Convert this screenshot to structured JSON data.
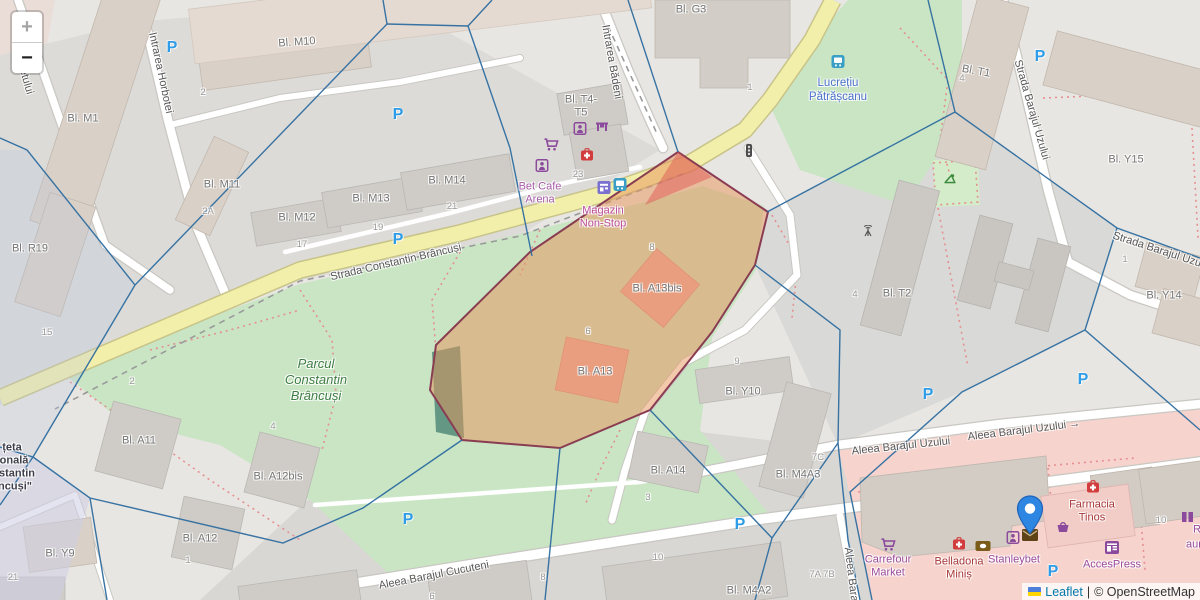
{
  "controls": {
    "zoom_in": "+",
    "zoom_out": "−"
  },
  "attribution": {
    "flag": "ukraine-flag",
    "leaflet": "Leaflet",
    "separator": "|",
    "osm": "© OpenStreetMap"
  },
  "colors": {
    "road_yellow": "#f2efab",
    "park_green": "#c9e5c4",
    "retail_pink": "#f6d3cd",
    "overlay_orange_fill": "#e8935a",
    "overlay_stroke": "#8a3d52",
    "mesh_blue": "#2e6da0",
    "marker_blue": "#2e86e3",
    "parking_blue": "#2e9ce6",
    "shop_purple": "#9b4a9b",
    "pharmacy_red": "#a83838",
    "transit_blue": "#4a70ca",
    "park_label_green": "#3e7d43",
    "leaflet_link": "#0078a8",
    "building_beige": "#d9d0c7",
    "building_grey": "#cfccc7",
    "highlight_building_pink": "#eba9a4"
  },
  "map": {
    "labels": [
      {
        "n": "street-intrarea-horbotei",
        "t": "Intrarea Horbotei",
        "x": 160,
        "y": 73,
        "r": 78,
        "c": "street"
      },
      {
        "n": "street-partial-chetului",
        "t": "chetului",
        "x": 24,
        "y": 76,
        "r": 74,
        "c": "street"
      },
      {
        "n": "street-intrarea-badeni",
        "t": "Intrarea Bădeni",
        "x": 611,
        "y": 62,
        "r": 80,
        "c": "street"
      },
      {
        "n": "street-barajul-uzului-vertical",
        "t": "Strada Barajul Uzului",
        "x": 1031,
        "y": 110,
        "r": 74,
        "c": "street"
      },
      {
        "n": "street-constantin-brancusi",
        "t": "Strada Constantin Brâncuși",
        "x": 396,
        "y": 263,
        "r": -13,
        "c": "street"
      },
      {
        "n": "street-barajul-uzului-diagonal",
        "t": "Strada Barajul Uzului",
        "x": 1162,
        "y": 252,
        "r": 18,
        "c": "street"
      },
      {
        "n": "street-aleea-barajul-cucuteni",
        "t": "Aleea Barajul Cucuteni",
        "x": 434,
        "y": 576,
        "r": -11,
        "c": "street"
      },
      {
        "n": "street-aleea-barajul-uzului-1",
        "t": "Aleea Barajul Uzului",
        "x": 901,
        "y": 447,
        "r": -6,
        "c": "street"
      },
      {
        "n": "street-aleea-barajul-uzului-2",
        "t": "Aleea Barajul Uzului →",
        "x": 1024,
        "y": 431,
        "r": -7,
        "c": "street"
      },
      {
        "n": "street-aleea-barajul-vertical",
        "t": "Aleea Barajul",
        "x": 851,
        "y": 580,
        "r": 83,
        "c": "street"
      },
      {
        "n": "bldg-m10",
        "t": "Bl. M10",
        "x": 297,
        "y": 43,
        "r": -4,
        "c": "bldg"
      },
      {
        "n": "bldg-m1",
        "t": "Bl. M1",
        "x": 83,
        "y": 119,
        "r": 0,
        "c": "bldg"
      },
      {
        "n": "bldg-m11",
        "t": "Bl. M11",
        "x": 222,
        "y": 185,
        "r": 0,
        "c": "bldg"
      },
      {
        "n": "bldg-m12",
        "t": "Bl. M12",
        "x": 297,
        "y": 218,
        "r": 0,
        "c": "bldg"
      },
      {
        "n": "bldg-m13",
        "t": "Bl. M13",
        "x": 371,
        "y": 199,
        "r": 0,
        "c": "bldg"
      },
      {
        "n": "bldg-m14",
        "t": "Bl. M14",
        "x": 447,
        "y": 181,
        "r": 0,
        "c": "bldg"
      },
      {
        "n": "bldg-t4-t5",
        "t": [
          "Bl. T4-",
          "T5"
        ],
        "x": 581,
        "y": 107,
        "r": 0,
        "c": "bldg"
      },
      {
        "n": "bldg-g3",
        "t": "Bl. G3",
        "x": 691,
        "y": 10,
        "r": 0,
        "c": "bldg"
      },
      {
        "n": "bldg-t1",
        "t": "Bl. T1",
        "x": 976,
        "y": 72,
        "r": 10,
        "c": "bldg"
      },
      {
        "n": "bldg-y15",
        "t": "Bl. Y15",
        "x": 1126,
        "y": 160,
        "r": 0,
        "c": "bldg"
      },
      {
        "n": "bldg-r19",
        "t": "Bl. R19",
        "x": 30,
        "y": 249,
        "r": 0,
        "c": "bldg"
      },
      {
        "n": "bldg-y14",
        "t": "Bl. Y14",
        "x": 1164,
        "y": 296,
        "r": 0,
        "c": "bldg"
      },
      {
        "n": "bldg-t2",
        "t": "Bl. T2",
        "x": 897,
        "y": 294,
        "r": 0,
        "c": "bldg"
      },
      {
        "n": "bldg-a13bis",
        "t": "Bl. A13bis",
        "x": 657,
        "y": 289,
        "r": 0,
        "c": "bldg"
      },
      {
        "n": "bldg-a13",
        "t": "Bl. A13",
        "x": 595,
        "y": 372,
        "r": 0,
        "c": "bldg"
      },
      {
        "n": "bldg-y10",
        "t": "Bl. Y10",
        "x": 743,
        "y": 392,
        "r": 0,
        "c": "bldg"
      },
      {
        "n": "bldg-a11",
        "t": "Bl. A11",
        "x": 139,
        "y": 441,
        "r": 0,
        "c": "bldg"
      },
      {
        "n": "bldg-a12bis",
        "t": "Bl. A12bis",
        "x": 278,
        "y": 477,
        "r": 0,
        "c": "bldg"
      },
      {
        "n": "bldg-a12",
        "t": "Bl. A12",
        "x": 200,
        "y": 539,
        "r": 0,
        "c": "bldg"
      },
      {
        "n": "bldg-y9",
        "t": "Bl. Y9",
        "x": 60,
        "y": 554,
        "r": 0,
        "c": "bldg"
      },
      {
        "n": "bldg-a14",
        "t": "Bl. A14",
        "x": 668,
        "y": 471,
        "r": 0,
        "c": "bldg"
      },
      {
        "n": "bldg-m4a3",
        "t": "Bl. M4A3",
        "x": 798,
        "y": 475,
        "r": 0,
        "c": "bldg"
      },
      {
        "n": "bldg-m4a2",
        "t": "Bl. M4A2",
        "x": 749,
        "y": 591,
        "r": 0,
        "c": "bldg"
      },
      {
        "n": "num-15",
        "t": "15",
        "x": 47,
        "y": 333,
        "r": 0,
        "c": "num"
      },
      {
        "n": "num-2-top",
        "t": "2",
        "x": 203,
        "y": 93,
        "r": 0,
        "c": "num"
      },
      {
        "n": "num-2a",
        "t": "2A",
        "x": 208,
        "y": 212,
        "r": 0,
        "c": "num"
      },
      {
        "n": "num-2-park",
        "t": "2",
        "x": 132,
        "y": 382,
        "r": 0,
        "c": "num"
      },
      {
        "n": "num-4-a12bis",
        "t": "4",
        "x": 273,
        "y": 427,
        "r": 0,
        "c": "num"
      },
      {
        "n": "num-21-y9",
        "t": "21",
        "x": 13,
        "y": 578,
        "r": 0,
        "c": "num"
      },
      {
        "n": "num-1-a12",
        "t": "1",
        "x": 188,
        "y": 561,
        "r": 0,
        "c": "num"
      },
      {
        "n": "num-23",
        "t": "23",
        "x": 578,
        "y": 175,
        "r": 0,
        "c": "num"
      },
      {
        "n": "num-21",
        "t": "21",
        "x": 452,
        "y": 207,
        "r": 0,
        "c": "num"
      },
      {
        "n": "num-19",
        "t": "19",
        "x": 378,
        "y": 228,
        "r": 0,
        "c": "num"
      },
      {
        "n": "num-17",
        "t": "17",
        "x": 302,
        "y": 245,
        "r": 0,
        "c": "num"
      },
      {
        "n": "num-1-g3",
        "t": "1",
        "x": 750,
        "y": 88,
        "r": 0,
        "c": "num"
      },
      {
        "n": "num-4-t1",
        "t": "4",
        "x": 962,
        "y": 79,
        "r": 0,
        "c": "num"
      },
      {
        "n": "num-8-a13bis",
        "t": "8",
        "x": 652,
        "y": 248,
        "r": 0,
        "c": "num"
      },
      {
        "n": "num-6-a13",
        "t": "6",
        "x": 588,
        "y": 332,
        "r": 0,
        "c": "num"
      },
      {
        "n": "num-9-y10",
        "t": "9",
        "x": 737,
        "y": 362,
        "r": 0,
        "c": "num"
      },
      {
        "n": "num-4-t2",
        "t": "4",
        "x": 855,
        "y": 295,
        "r": 0,
        "c": "num"
      },
      {
        "n": "num-1-y14",
        "t": "1",
        "x": 1125,
        "y": 260,
        "r": 0,
        "c": "num"
      },
      {
        "n": "num-3-a14",
        "t": "3",
        "x": 648,
        "y": 498,
        "r": 0,
        "c": "num"
      },
      {
        "n": "num-7c",
        "t": "7C",
        "x": 818,
        "y": 458,
        "r": 0,
        "c": "num"
      },
      {
        "n": "num-7a-7b",
        "t": "7A 7B",
        "x": 822,
        "y": 575,
        "r": 0,
        "c": "num"
      },
      {
        "n": "num-10",
        "t": "10",
        "x": 658,
        "y": 558,
        "r": 0,
        "c": "num"
      },
      {
        "n": "num-8-road",
        "t": "8",
        "x": 543,
        "y": 578,
        "r": 0,
        "c": "num"
      },
      {
        "n": "num-6-road",
        "t": "6",
        "x": 432,
        "y": 597,
        "r": 0,
        "c": "num"
      },
      {
        "n": "num-10-right",
        "t": "10",
        "x": 1161,
        "y": 521,
        "r": 0,
        "c": "num"
      },
      {
        "n": "poi-bet-cafe-arena",
        "t": [
          "Bet Cafe",
          "Arena"
        ],
        "x": 540,
        "y": 194,
        "r": 0,
        "c": "shop"
      },
      {
        "n": "poi-magazin-non-stop",
        "t": [
          "Magazin",
          "Non-Stop"
        ],
        "x": 603,
        "y": 218,
        "r": 0,
        "c": "shop2"
      },
      {
        "n": "poi-lucretiu-patrascanu",
        "t": [
          "Lucrețiu",
          "Pătrășcanu"
        ],
        "x": 838,
        "y": 90,
        "r": 0,
        "c": "transit"
      },
      {
        "n": "poi-parcul-constantin-brancusi",
        "t": [
          "Parcul",
          "Constantin",
          "Brâncuși"
        ],
        "x": 316,
        "y": 380,
        "r": 0,
        "c": "park"
      },
      {
        "n": "poi-civic-line1",
        "t": "țeta",
        "x": 12,
        "y": 448,
        "r": 0,
        "c": "civic"
      },
      {
        "n": "poi-civic-line2",
        "t": "onală",
        "x": 14,
        "y": 461,
        "r": 0,
        "c": "civic"
      },
      {
        "n": "poi-civic-line3",
        "t": "stantin",
        "x": 17,
        "y": 474,
        "r": 0,
        "c": "civic"
      },
      {
        "n": "poi-civic-line4",
        "t": "ncuși\"",
        "x": 15,
        "y": 487,
        "r": 0,
        "c": "civic"
      },
      {
        "n": "poi-carrefour-market",
        "t": [
          "Carrefour",
          "Market"
        ],
        "x": 888,
        "y": 567,
        "r": 0,
        "c": "shop3"
      },
      {
        "n": "poi-belladona-minis",
        "t": [
          "Belladona",
          "Miniș"
        ],
        "x": 959,
        "y": 569,
        "r": 0,
        "c": "pharma"
      },
      {
        "n": "poi-stanleybet",
        "t": "Stanleybet",
        "x": 1014,
        "y": 560,
        "r": 0,
        "c": "shop3"
      },
      {
        "n": "poi-accespress",
        "t": "AccesPress",
        "x": 1112,
        "y": 565,
        "r": 0,
        "c": "shop3"
      },
      {
        "n": "poi-farmacia-tinos",
        "t": [
          "Farmacia",
          "Tinos"
        ],
        "x": 1092,
        "y": 512,
        "r": 0,
        "c": "pharma"
      },
      {
        "n": "poi-partial-r",
        "t": "R",
        "x": 1197,
        "y": 530,
        "r": 0,
        "c": "shop3"
      },
      {
        "n": "poi-partial-aur",
        "t": "aur",
        "x": 1194,
        "y": 545,
        "r": 0,
        "c": "shop3"
      }
    ],
    "icons": [
      {
        "n": "parking-icon",
        "type": "parking",
        "x": 172,
        "y": 48
      },
      {
        "n": "parking-icon",
        "type": "parking",
        "x": 398,
        "y": 115
      },
      {
        "n": "parking-icon",
        "type": "parking",
        "x": 398,
        "y": 240
      },
      {
        "n": "parking-icon",
        "type": "parking",
        "x": 408,
        "y": 520
      },
      {
        "n": "parking-icon",
        "type": "parking",
        "x": 740,
        "y": 525
      },
      {
        "n": "parking-icon",
        "type": "parking",
        "x": 928,
        "y": 395
      },
      {
        "n": "parking-icon",
        "type": "parking",
        "x": 1083,
        "y": 380
      },
      {
        "n": "parking-icon",
        "type": "parking",
        "x": 1040,
        "y": 57
      },
      {
        "n": "parking-icon",
        "type": "parking",
        "x": 1053,
        "y": 572
      },
      {
        "n": "traffic-light-icon",
        "type": "trafficlight",
        "x": 749,
        "y": 153
      },
      {
        "n": "bus-stop-icon",
        "type": "busstop",
        "x": 838,
        "y": 64
      },
      {
        "n": "bus-stop-icon",
        "type": "busstop",
        "x": 620,
        "y": 187
      },
      {
        "n": "kiosk-icon",
        "type": "kiosk",
        "x": 604,
        "y": 190
      },
      {
        "n": "shopping-cart-icon",
        "type": "cart",
        "x": 551,
        "y": 147
      },
      {
        "n": "arcade-icon",
        "type": "arcade",
        "x": 580,
        "y": 131
      },
      {
        "n": "table-icon",
        "type": "table",
        "x": 602,
        "y": 128
      },
      {
        "n": "first-aid-icon",
        "type": "firstaid",
        "x": 587,
        "y": 157
      },
      {
        "n": "arcade-icon",
        "type": "arcade",
        "x": 542,
        "y": 168
      },
      {
        "n": "antenna-icon",
        "type": "antenna",
        "x": 868,
        "y": 233
      },
      {
        "n": "playground-icon",
        "type": "playground",
        "x": 950,
        "y": 180
      },
      {
        "n": "shopping-cart-icon",
        "type": "cart",
        "x": 888,
        "y": 547
      },
      {
        "n": "first-aid-icon",
        "type": "firstaid",
        "x": 959,
        "y": 546
      },
      {
        "n": "money-exchange-icon",
        "type": "money",
        "x": 983,
        "y": 547
      },
      {
        "n": "arcade-icon",
        "type": "arcade",
        "x": 1013,
        "y": 540
      },
      {
        "n": "mail-icon",
        "type": "envelope",
        "x": 1030,
        "y": 537
      },
      {
        "n": "basket-icon",
        "type": "basket",
        "x": 1063,
        "y": 529
      },
      {
        "n": "first-aid-icon",
        "type": "firstaid",
        "x": 1093,
        "y": 489
      },
      {
        "n": "newsagent-icon",
        "type": "newspaper",
        "x": 1112,
        "y": 550
      },
      {
        "n": "shop-partial-icon",
        "type": "partialshop",
        "x": 1188,
        "y": 519
      },
      {
        "n": "map-marker-icon",
        "type": "marker",
        "x": 1030,
        "y": 540
      }
    ]
  }
}
